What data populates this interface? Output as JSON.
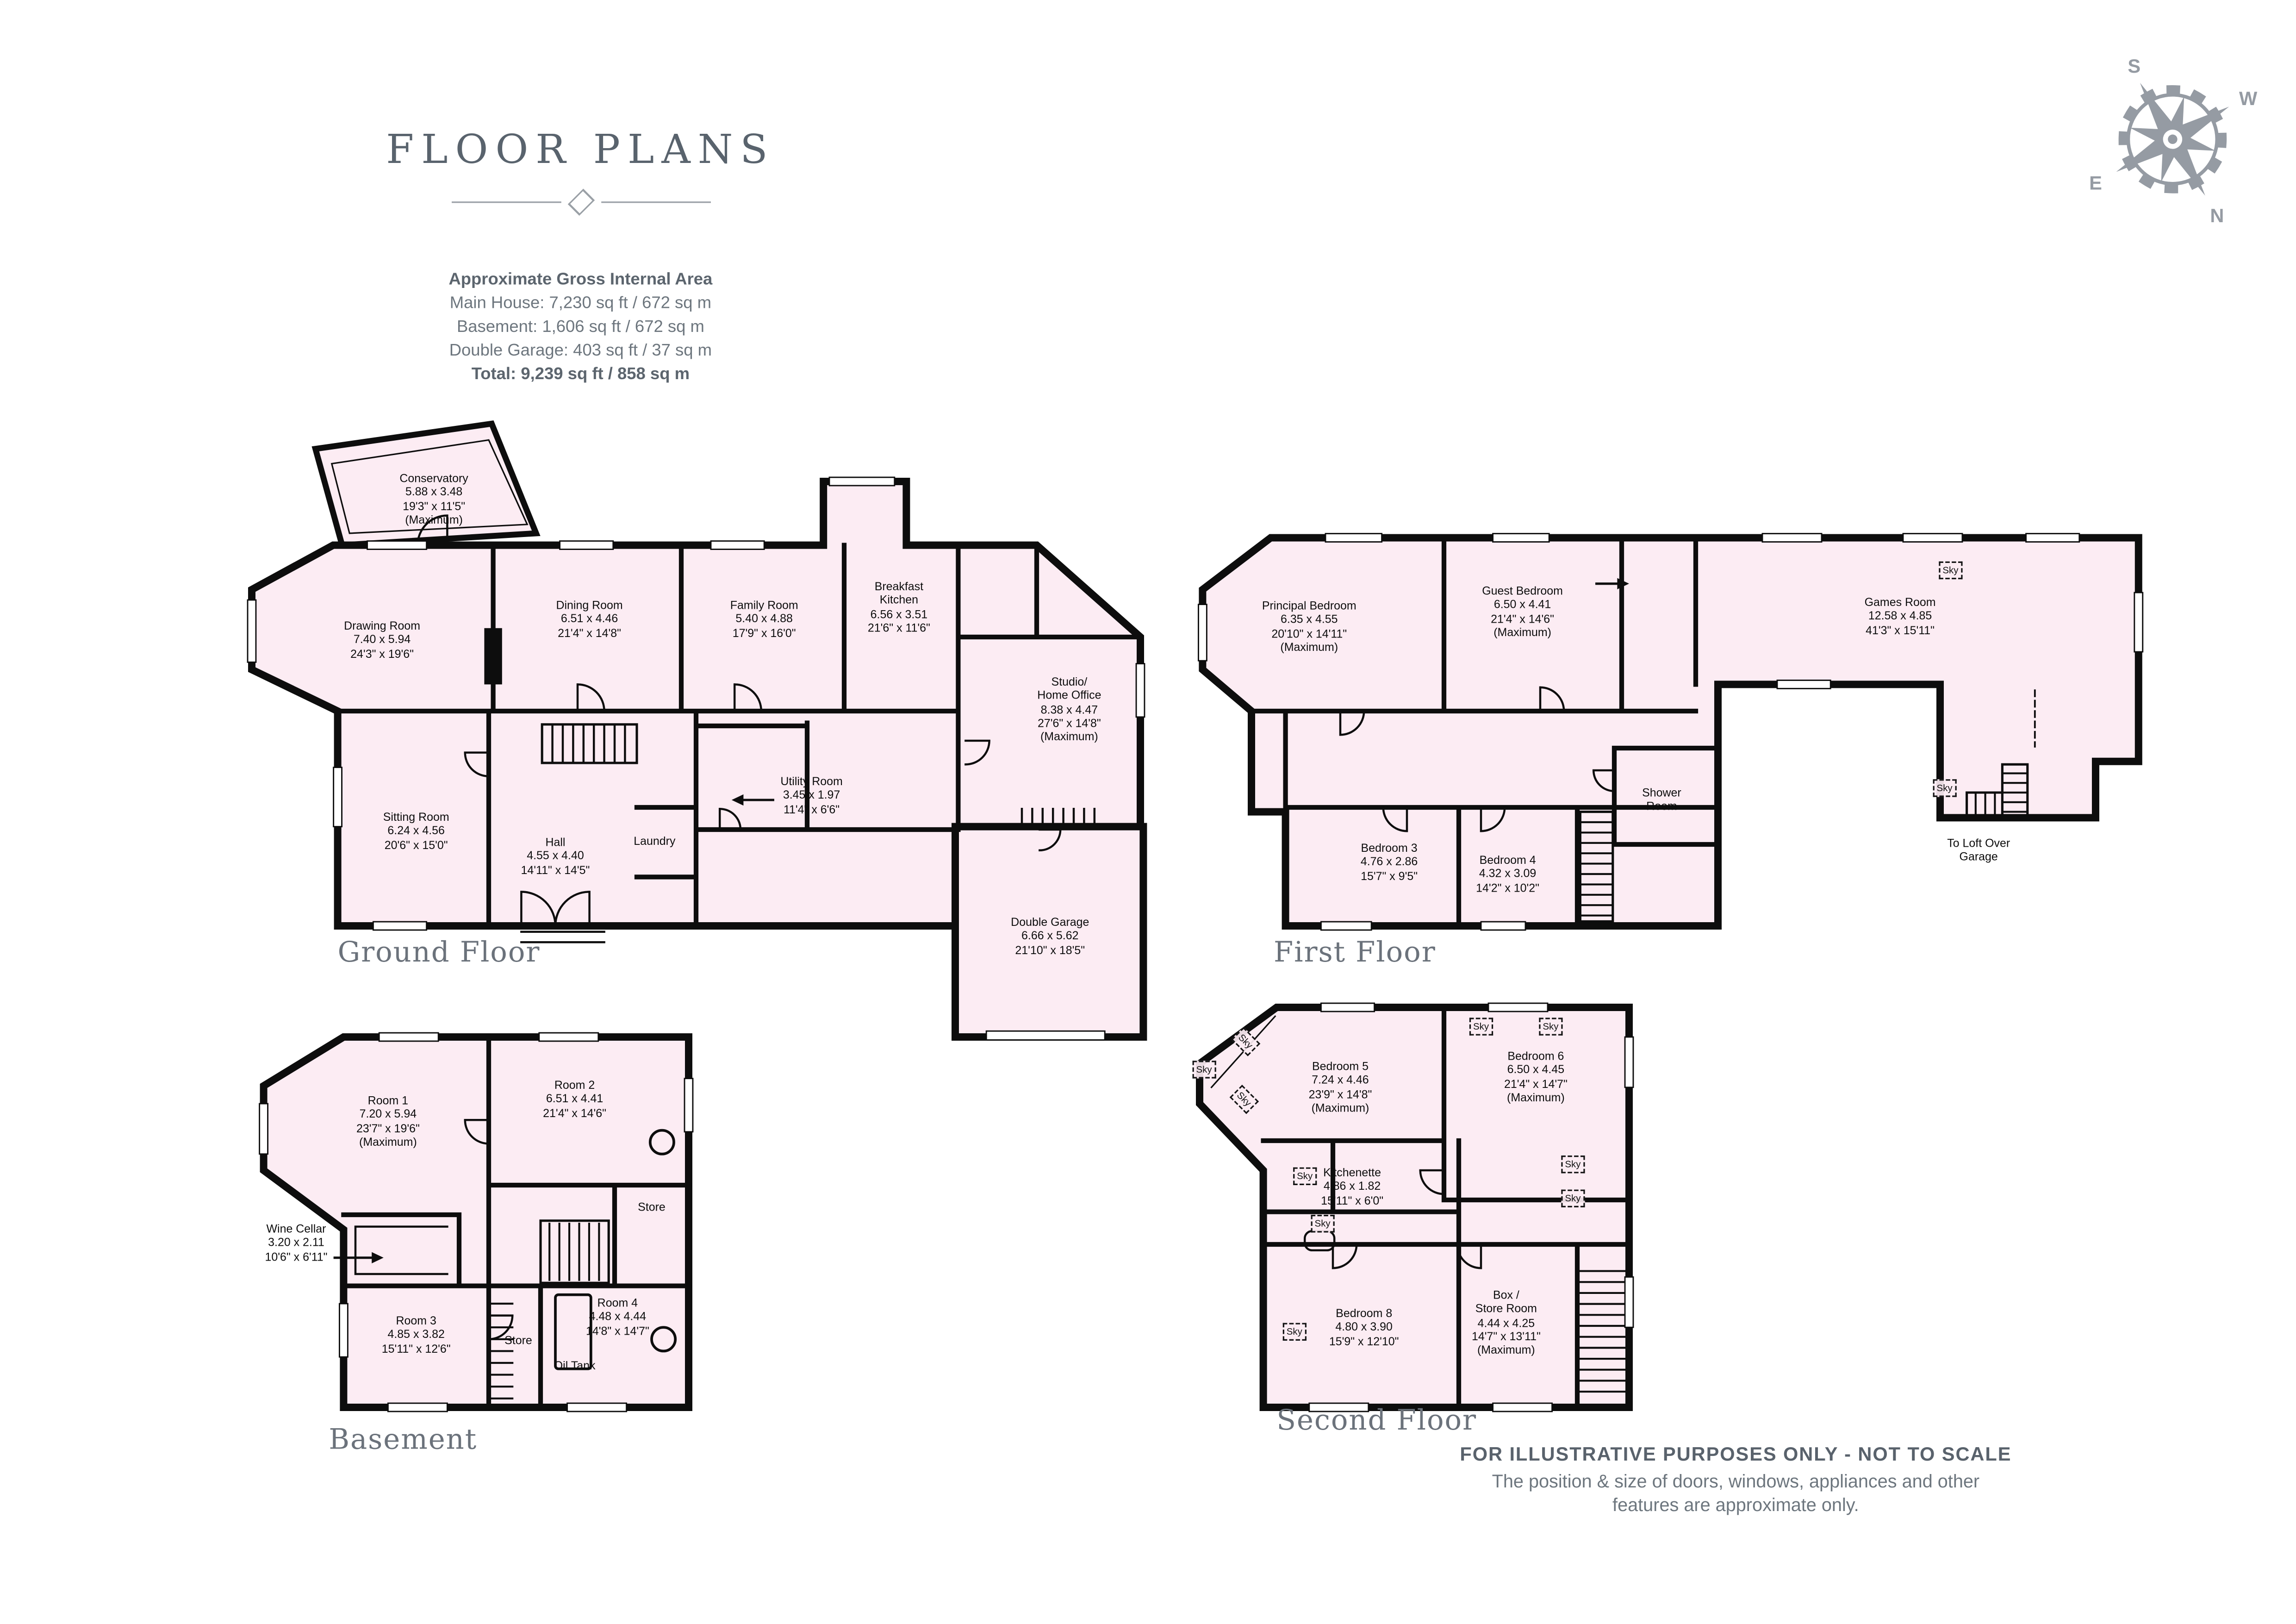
{
  "title": "FLOOR PLANS",
  "area_summary": {
    "heading": "Approximate Gross Internal Area",
    "lines": [
      "Main House: 7,230 sq ft / 672 sq m",
      "Basement: 1,606 sq ft / 672 sq m",
      "Double Garage: 403 sq ft / 37 sq m"
    ],
    "total": "Total: 9,239 sq ft / 858 sq m"
  },
  "compass": {
    "n": "N",
    "s": "S",
    "e": "E",
    "w": "W"
  },
  "labels": {
    "sky": "Sky"
  },
  "floors": [
    {
      "name": "Ground Floor",
      "rooms": [
        {
          "id": "conservatory",
          "lines": [
            "Conservatory",
            "5.88 x 3.48",
            "19'3\" x 11'5\"",
            "(Maximum)"
          ]
        },
        {
          "id": "drawing-room",
          "lines": [
            "Drawing Room",
            "7.40 x 5.94",
            "24'3\" x 19'6\""
          ]
        },
        {
          "id": "dining-room",
          "lines": [
            "Dining Room",
            "6.51 x 4.46",
            "21'4\" x 14'8\""
          ]
        },
        {
          "id": "family-room",
          "lines": [
            "Family Room",
            "5.40 x 4.88",
            "17'9\" x 16'0\""
          ]
        },
        {
          "id": "breakfast-kitchen",
          "lines": [
            "Breakfast",
            "Kitchen",
            "6.56 x 3.51",
            "21'6\" x 11'6\""
          ]
        },
        {
          "id": "studio-home-office",
          "lines": [
            "Studio/",
            "Home Office",
            "8.38 x 4.47",
            "27'6\" x 14'8\"",
            "(Maximum)"
          ]
        },
        {
          "id": "utility-room",
          "lines": [
            "Utility Room",
            "3.45 x 1.97",
            "11'4\" x 6'6\""
          ]
        },
        {
          "id": "sitting-room",
          "lines": [
            "Sitting Room",
            "6.24 x 4.56",
            "20'6\" x 15'0\""
          ]
        },
        {
          "id": "hall",
          "lines": [
            "Hall",
            "4.55 x 4.40",
            "14'11\" x 14'5\""
          ]
        },
        {
          "id": "laundry",
          "lines": [
            "Laundry"
          ]
        },
        {
          "id": "double-garage",
          "lines": [
            "Double Garage",
            "6.66 x 5.62",
            "21'10\" x 18'5\""
          ]
        }
      ]
    },
    {
      "name": "First Floor",
      "rooms": [
        {
          "id": "principal-bedroom",
          "lines": [
            "Principal Bedroom",
            "6.35 x 4.55",
            "20'10\" x 14'11\"",
            "(Maximum)"
          ]
        },
        {
          "id": "guest-bedroom",
          "lines": [
            "Guest Bedroom",
            "6.50 x 4.41",
            "21'4\" x 14'6\"",
            "(Maximum)"
          ]
        },
        {
          "id": "games-room",
          "lines": [
            "Games Room",
            "12.58 x 4.85",
            "41'3\" x 15'11\""
          ]
        },
        {
          "id": "shower-room",
          "lines": [
            "Shower",
            "Room"
          ]
        },
        {
          "id": "bedroom-3",
          "lines": [
            "Bedroom 3",
            "4.76 x 2.86",
            "15'7\" x 9'5\""
          ]
        },
        {
          "id": "bedroom-4",
          "lines": [
            "Bedroom 4",
            "4.32 x 3.09",
            "14'2\" x 10'2\""
          ]
        },
        {
          "id": "loft-access",
          "lines": [
            "To Loft Over",
            "Garage"
          ]
        }
      ]
    },
    {
      "name": "Basement",
      "rooms": [
        {
          "id": "room-1",
          "lines": [
            "Room 1",
            "7.20 x 5.94",
            "23'7\" x 19'6\"",
            "(Maximum)"
          ]
        },
        {
          "id": "room-2",
          "lines": [
            "Room 2",
            "6.51 x 4.41",
            "21'4\" x 14'6\""
          ]
        },
        {
          "id": "store-upper",
          "lines": [
            "Store"
          ]
        },
        {
          "id": "wine-cellar",
          "lines": [
            "Wine Cellar",
            "3.20 x 2.11",
            "10'6\" x 6'11\""
          ]
        },
        {
          "id": "room-3",
          "lines": [
            "Room 3",
            "4.85 x 3.82",
            "15'11\" x 12'6\""
          ]
        },
        {
          "id": "store-lower",
          "lines": [
            "Store"
          ]
        },
        {
          "id": "room-4",
          "lines": [
            "Room 4",
            "4.48 x 4.44",
            "14'8\" x 14'7\""
          ]
        },
        {
          "id": "oil-tank",
          "lines": [
            "Oil Tank"
          ]
        }
      ]
    },
    {
      "name": "Second Floor",
      "rooms": [
        {
          "id": "bedroom-5",
          "lines": [
            "Bedroom 5",
            "7.24 x 4.46",
            "23'9\" x 14'8\"",
            "(Maximum)"
          ]
        },
        {
          "id": "bedroom-6",
          "lines": [
            "Bedroom 6",
            "6.50 x 4.45",
            "21'4\" x 14'7\"",
            "(Maximum)"
          ]
        },
        {
          "id": "kitchenette",
          "lines": [
            "Kitchenette",
            "4.86 x 1.82",
            "15'11\" x 6'0\""
          ]
        },
        {
          "id": "bedroom-8",
          "lines": [
            "Bedroom 8",
            "4.80 x 3.90",
            "15'9\" x 12'10\""
          ]
        },
        {
          "id": "box-store-room",
          "lines": [
            "Box /",
            "Store Room",
            "4.44 x 4.25",
            "14'7\" x 13'11\"",
            "(Maximum)"
          ]
        }
      ]
    }
  ],
  "footer": {
    "line1": "FOR ILLUSTRATIVE PURPOSES ONLY - NOT TO SCALE",
    "line2": "The position & size of doors, windows, appliances and other",
    "line3": "features are approximate only."
  }
}
